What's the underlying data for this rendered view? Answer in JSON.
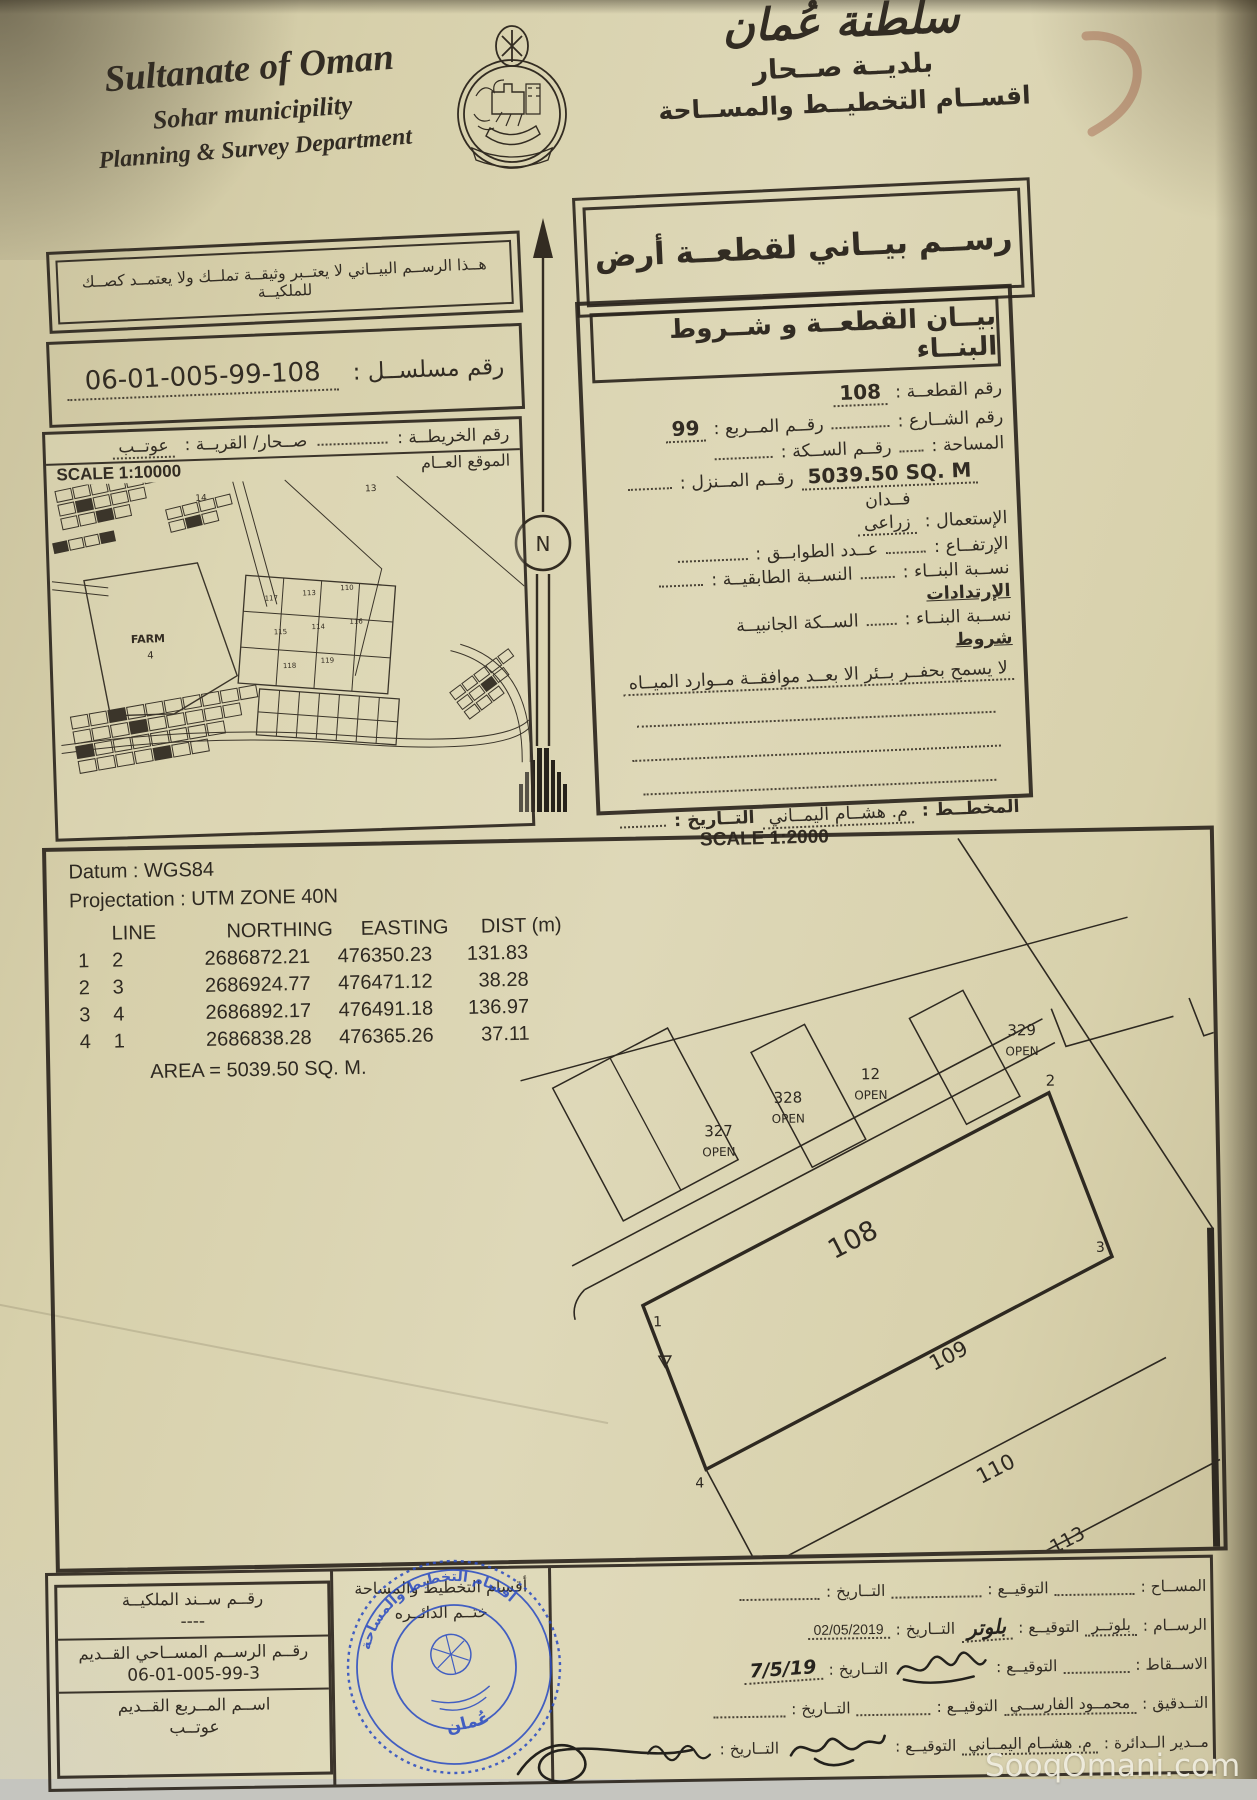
{
  "header": {
    "title_en": "Sultanate of Oman",
    "municipality_en": "Sohar municipility",
    "dept_en": "Planning & Survey Department",
    "title_ar": "سلطنة عُمان",
    "municipality_ar": "بلديــة صــحار",
    "dept_ar": "اقســام التخطيــط والمســاحة"
  },
  "doc": {
    "drawing_title": "رســم بيــاني لقطعــة أرض",
    "disclaimer": "هــذا الرســم البيــاني لا يعتــبر وثيقــة تملــك ولا يعتمــد كصــك للملكيــة",
    "serial_label": "رقم مسلســل :",
    "serial_value": "06-01-005-99-108"
  },
  "map": {
    "map_no_label": "رقم الخريطــة :",
    "wilaya_label": "صــحار/ القريــة :",
    "village_value": "عوتــب",
    "location_label": "الموقع العــام",
    "scale_label": "SCALE 1:10000",
    "north_label": "N",
    "farm_label": "FARM",
    "farm_no": "4",
    "label_13": "13",
    "label_14": "14",
    "grid_labels": [
      "117",
      "113",
      "110",
      "115",
      "114",
      "116",
      "118",
      "119"
    ]
  },
  "details": {
    "title": "بيــان القطعــة و شــروط البنــاء",
    "plot_no_label": "رقم القطعــة :",
    "plot_no": "108",
    "street_label": "رقم الشــارع :",
    "square_label": "رقــم المــربع :",
    "square_value": "99",
    "area_label": "المساحة :",
    "lane_label": "رقــم الســكة :",
    "house_label": "رقــم المــنزل :",
    "area_value": "5039.50 SQ. M",
    "area_unit": "فــدان",
    "use_label": "الإستعمال :",
    "use_value": "زراعى",
    "height_label": "الإرتفــاع :",
    "floors_label": "عــدد الطوابــق :",
    "build_ratio_label": "نســبة البنــاء :",
    "floor_ratio_label": "النســبة الطابقيــة :",
    "setbacks_title": "الإرتدادات",
    "side_build_label": "نســبة البنــاء :",
    "side_lane_label": "الســكة الجانبيــة",
    "conditions_title": "شروط",
    "condition_text": "لا يسمح بحفــر بــئر الا بعــد موافقــة مــوارد الميــاه",
    "planner_label": "المخطــط :",
    "planner_name": "م. هشــام اليمــاني",
    "date_label": "التــاريخ :"
  },
  "survey": {
    "scale_label": "SCALE 1:2000",
    "datum_line": "Datum : WGS84",
    "projection_line": "Projectation : UTM ZONE 40N",
    "columns": [
      "LINE",
      "NORTHING",
      "EASTING",
      "DIST (m)"
    ],
    "rows": [
      {
        "from": "1",
        "to": "2",
        "northing": "2686872.21",
        "easting": "476350.23",
        "dist": "131.83"
      },
      {
        "from": "2",
        "to": "3",
        "northing": "2686924.77",
        "easting": "476471.12",
        "dist": "38.28"
      },
      {
        "from": "3",
        "to": "4",
        "northing": "2686892.17",
        "easting": "476491.18",
        "dist": "136.97"
      },
      {
        "from": "4",
        "to": "1",
        "northing": "2686838.28",
        "easting": "476365.26",
        "dist": "37.11"
      }
    ],
    "area_line": "AREA = 5039.50 SQ. M."
  },
  "sketch": {
    "main_plot": "108",
    "plot_109": "109",
    "plot_110": "110",
    "plot_113": "113",
    "corner_labels": [
      "1",
      "2",
      "3",
      "4"
    ],
    "open_tag": "OPEN",
    "parcel_327": "327",
    "parcel_328": "328",
    "parcel_12": "12",
    "parcel_329": "329"
  },
  "footer": {
    "left_rows": [
      {
        "label": "رقــم ســند الملكيــة",
        "value": "----"
      },
      {
        "label": "رقــم الرســم المســاحي القــديم",
        "value": "06-01-005-99-3"
      },
      {
        "label": "اســم المــربع القــديم",
        "value": "عوتــب"
      }
    ],
    "stamp_cell_line1": "أقسام التخطيط والمساحة",
    "stamp_cell_line2": "ختــم الدائــره",
    "stamp": {
      "ring_text": "أقسام التخطيط والمساحة",
      "center_text": "عُمان"
    },
    "sign_rows": [
      {
        "label": "المســاح :",
        "value": "",
        "sig_label": "التوقيــع :",
        "sig_text": "",
        "date_label": "التــاريخ :",
        "date": ""
      },
      {
        "label": "الرســام :",
        "value": "بلوتــر",
        "sig_label": "التوقيــع :",
        "sig_text": "بلوتر",
        "date_label": "التــاريخ :",
        "date": "02/05/2019"
      },
      {
        "label": "الاســقاط :",
        "value": "",
        "sig_label": "التوقيــع :",
        "sig_text": "",
        "date_label": "التــاريخ :",
        "date": "7/5/19"
      },
      {
        "label": "التــدقيق :",
        "value": "محمــود الفارســي",
        "sig_label": "التوقيــع :",
        "sig_text": "",
        "date_label": "التــاريخ :",
        "date": ""
      },
      {
        "label": "مــدير الــدائرة :",
        "value": "م. هشــام اليمــاني",
        "sig_label": "التوقيــع :",
        "sig_text": "",
        "date_label": "التــاريخ :",
        "date": ""
      }
    ],
    "watermark": "SooqOmani.com"
  }
}
